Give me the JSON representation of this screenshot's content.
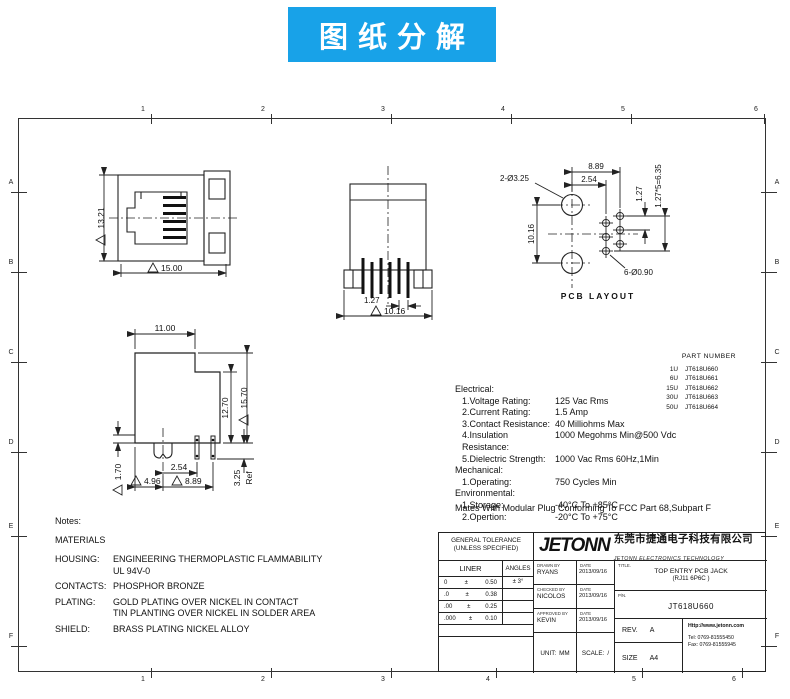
{
  "banner": {
    "text": "图纸分解",
    "bg": "#18a2e8",
    "fg": "#ffffff"
  },
  "colors": {
    "line": "#222222",
    "text": "#111111"
  },
  "zones": {
    "cols": [
      "1",
      "2",
      "3",
      "4",
      "5",
      "6"
    ],
    "rows": [
      "A",
      "B",
      "C",
      "D",
      "E",
      "F"
    ]
  },
  "sheet": {
    "views": {
      "front": {
        "h": "13.21",
        "w": "15.00"
      },
      "pins": {
        "pitch": "1.27",
        "span": "10.16"
      },
      "pcb": {
        "holes": "2-Ø3.25",
        "pads": "6-Ø0.90",
        "w": "8.89",
        "off": "2.54",
        "pitch": "1.27",
        "total": "1.27*5=6.35",
        "h": "10.16",
        "caption": "PCB LAYOUT"
      },
      "side": {
        "w": "11.00",
        "h1": "12.70",
        "h2": "15.70",
        "t": "1.70",
        "p1": "2.54",
        "p2": "4.96",
        "p3": "8.89",
        "tail": "3.25",
        "ref": "Ref"
      }
    },
    "part_table": {
      "title": "PART NUMBER",
      "rows": [
        {
          "qty": "1U",
          "pn": "JT618U660"
        },
        {
          "qty": "6U",
          "pn": "JT618U661"
        },
        {
          "qty": "15U",
          "pn": "JT618U662"
        },
        {
          "qty": "30U",
          "pn": "JT618U663"
        },
        {
          "qty": "50U",
          "pn": "JT618U664"
        }
      ]
    },
    "specs": {
      "h1": "Electrical:",
      "rows1": [
        {
          "label": "1.Voltage Rating:",
          "value": "125 Vac Rms"
        },
        {
          "label": "2.Current Rating:",
          "value": "1.5 Amp"
        },
        {
          "label": "3.Contact Resistance:",
          "value": "40 Milliohms Max"
        },
        {
          "label": "4.Insulation Resistance:",
          "value": "1000 Megohms Min@500 Vdc"
        },
        {
          "label": "5.Dielectric Strength:",
          "value": "1000 Vac Rms 60Hz,1Min"
        }
      ],
      "h2": "Mechanical:",
      "rows2": [
        {
          "label": "1.Operating:",
          "value": "750 Cycles Min"
        }
      ],
      "h3": "Environmental:",
      "rows3": [
        {
          "label": "1.Storage:",
          "value": "-40°C To +85°C"
        },
        {
          "label": "2.Opertion:",
          "value": "-20°C To +75°C"
        }
      ],
      "footer": "Mates With Modular Plug Conforming To FCC Part 68,Subpart F"
    },
    "notes": {
      "title": "Notes:",
      "subtitle": "MATERIALS",
      "rows": [
        {
          "label": "HOUSING:",
          "line1": "ENGINEERING THERMOPLASTIC FLAMMABILITY",
          "line2": "UL 94V-0"
        },
        {
          "label": "CONTACTS:",
          "line1": "PHOSPHOR BRONZE",
          "line2": ""
        },
        {
          "label": "PLATING:",
          "line1": "GOLD PLATING OVER NICKEL IN CONTACT",
          "line2": "TIN PLANTING OVER NICKEL IN SOLDER AREA"
        },
        {
          "label": "SHIELD:",
          "line1": "BRASS PLATING NICKEL ALLOY",
          "line2": ""
        }
      ]
    },
    "titleblock": {
      "tolerance": {
        "title1": "GENERAL TOLERANCE",
        "title2": "(UNLESS SPECIFIED)",
        "col1": "LINER",
        "col2": "ANGLES",
        "rows": [
          {
            "l": "0",
            "pm": "±",
            "r": "0.50",
            "a": "± 3°"
          },
          {
            "l": ".0",
            "pm": "±",
            "r": "0.38",
            "a": ""
          },
          {
            "l": ".00",
            "pm": "±",
            "r": "0.25",
            "a": ""
          },
          {
            "l": ".000",
            "pm": "±",
            "r": "0.10",
            "a": ""
          }
        ]
      },
      "company": {
        "logo": "JETONN",
        "cn": "东莞市捷通电子科技有限公司",
        "en": "JETONN ELECTRONICS TECHNOLOGY"
      },
      "approvals": {
        "drawn_label": "DRAWN BY",
        "drawn": "RYANS",
        "checked_label": "CHECKED BY",
        "checked": "NICOLOS",
        "approved_label": "APPROVED BY",
        "approved": "KEVIN",
        "date_label": "DATE",
        "date1": "2013/09/16",
        "date2": "2013/09/16",
        "date3": "2013/09/16"
      },
      "unit_label": "UNIT:",
      "unit": "MM",
      "scale_label": "SCALE:",
      "scale": "/",
      "title": {
        "label": "TITLE.",
        "line1": "TOP ENTRY PCB JACK",
        "line2": "(RJ11 6P6C )"
      },
      "pn": {
        "label": "P/N.",
        "value": "JT618U660"
      },
      "rev": {
        "label": "REV.",
        "value": "A"
      },
      "size": {
        "label": "SIZE",
        "value": "A4"
      },
      "contact": {
        "web": "Http://www.jetonn.com",
        "tel": "Tel:  0769-81555450",
        "fax": "Fax:  0769-81555945"
      }
    }
  }
}
